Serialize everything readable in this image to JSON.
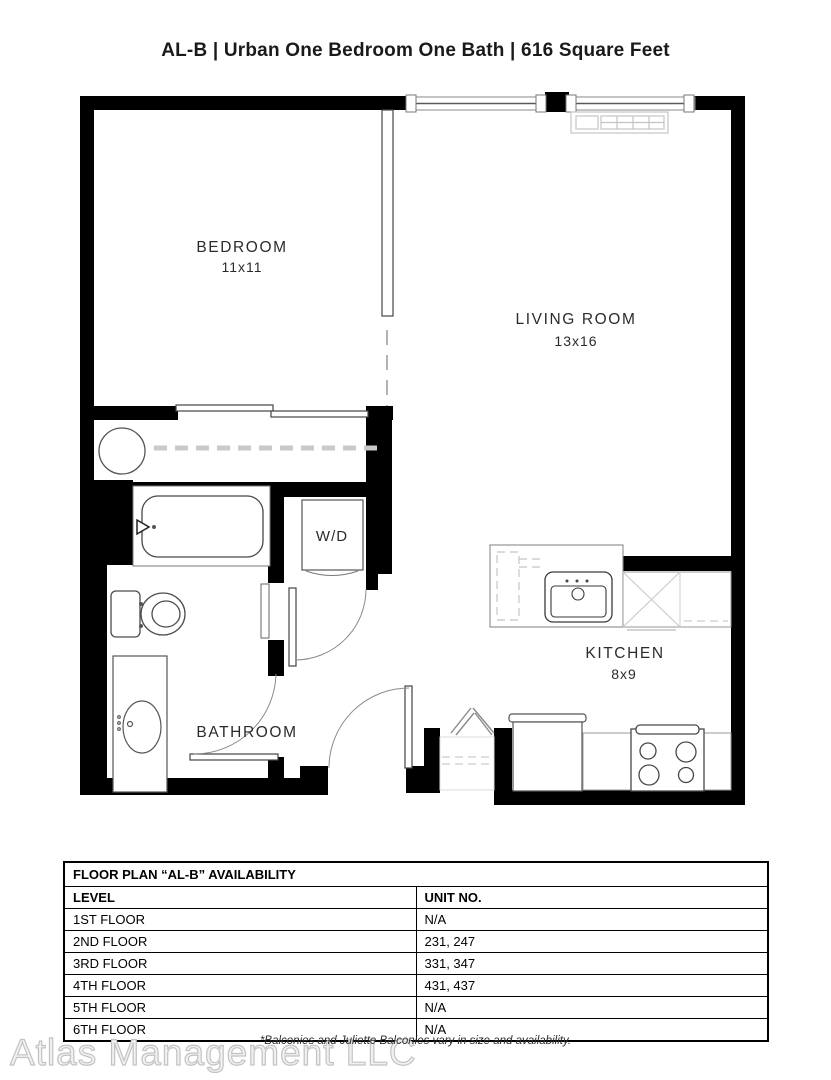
{
  "title": "AL-B | Urban One Bedroom One Bath | 616 Square Feet",
  "rooms": {
    "bedroom": {
      "name": "BEDROOM",
      "dims": "11x11"
    },
    "living_room": {
      "name": "LIVING ROOM",
      "dims": "13x16"
    },
    "kitchen": {
      "name": "KITCHEN",
      "dims": "8x9"
    },
    "bathroom": {
      "name": "BATHROOM"
    },
    "washer_dryer": {
      "label": "W/D"
    }
  },
  "availability_table": {
    "title": "FLOOR PLAN “AL-B” AVAILABILITY",
    "columns": {
      "level": "LEVEL",
      "unit": "UNIT NO."
    },
    "rows": [
      {
        "level": "1ST FLOOR",
        "unit": "N/A"
      },
      {
        "level": "2ND FLOOR",
        "unit": "231, 247"
      },
      {
        "level": "3RD FLOOR",
        "unit": "331, 347"
      },
      {
        "level": "4TH FLOOR",
        "unit": "431, 437"
      },
      {
        "level": "5TH FLOOR",
        "unit": "N/A"
      },
      {
        "level": "6TH FLOOR",
        "unit": "N/A"
      }
    ]
  },
  "footnote": "*Balconies and Juliette Balconies vary in size and availability.",
  "watermark": "Atlas Management LLC",
  "colors": {
    "wall": "#000000",
    "fixture_line": "#4c4c4c",
    "light_line": "#c4c4c4",
    "text": "#2b2b2b"
  }
}
